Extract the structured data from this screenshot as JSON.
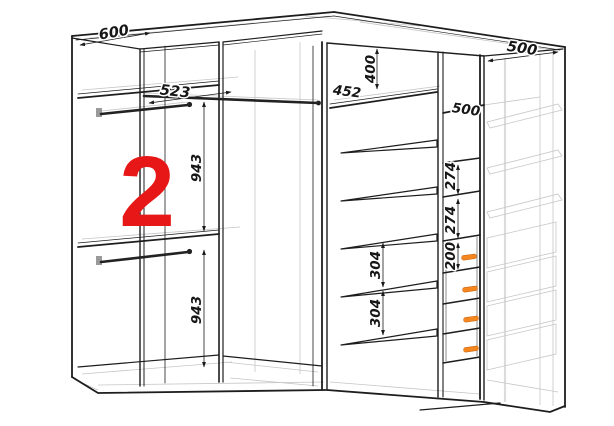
{
  "drawing": {
    "section_label": "2",
    "dimensions": {
      "top_left_width": "600",
      "top_right_width": "500",
      "rod_section_width": "523",
      "upper_hanging_height": "943",
      "lower_hanging_height": "943",
      "top_shelf_gap": "400",
      "shelf_width": "452",
      "shelf_depth": "500",
      "shelf_gap_upper": "274",
      "shelf_gap_lower": "274",
      "drawer_height": "200",
      "shelf_spacing_upper": "304",
      "shelf_spacing_lower": "304"
    },
    "colors": {
      "outline": "#1d1d1d",
      "hidden_lines": "#c6c6c6",
      "section_label_red": "#e81717",
      "drawer_handle_orange": "#f6871f",
      "background": "#ffffff"
    }
  }
}
